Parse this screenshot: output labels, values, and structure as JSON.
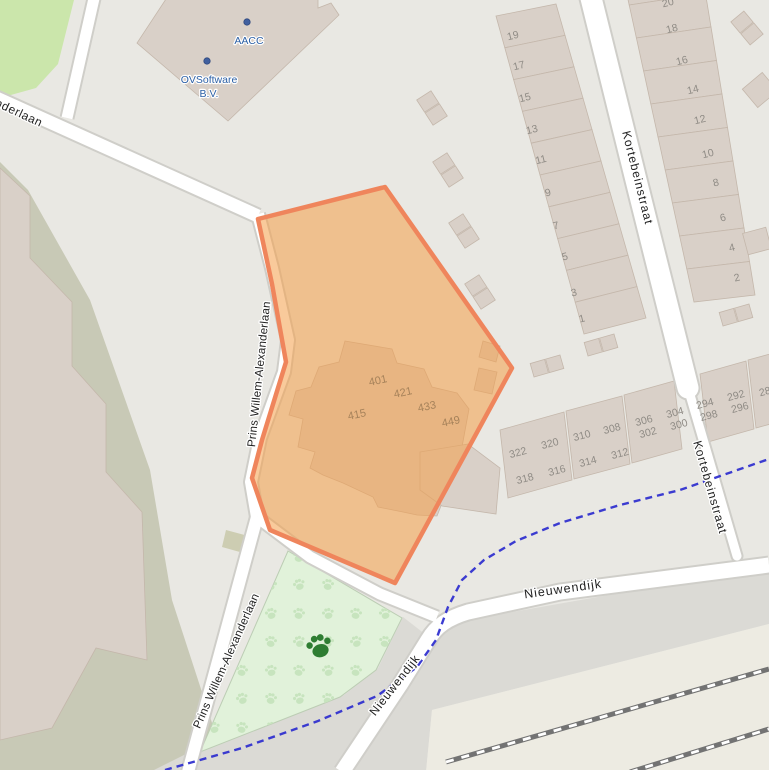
{
  "palette": {
    "bg": "#e9e8e3",
    "building": "#d9d0c8",
    "building_stroke": "#c4b7ab",
    "olive_parcel": "#c8c9b6",
    "grass": "#cbe6ab",
    "park_green": "#e1f2da",
    "park_paw": "#c7e4be",
    "park_paw_dark": "#2e7d32",
    "road_fill": "#ffffff",
    "road_casing": "#cfcec9",
    "gray_band": "#dbdad5",
    "rail_zone": "#edebe2",
    "rail_line": "#737373",
    "cycleway_blue": "#3232cf",
    "street_text": "#222222",
    "house_num_text": "#8f8b85",
    "plot_num_text": "#a6825a",
    "poi_text": "#2b5fa5",
    "poi_dot": "#41609f"
  },
  "selection": {
    "fill": "rgba(244,158,72,0.55)",
    "border": "#ef855c"
  },
  "streets": [
    {
      "label": "nderlaan",
      "x": -4,
      "y": 102,
      "r": 25,
      "fs": 12,
      "ls": 0.5,
      "anchor": "start"
    },
    {
      "label": "Prins Willem-Alexanderlaan",
      "x": 252,
      "y": 447,
      "r": -84,
      "fs": 11.5,
      "ls": 0.2,
      "anchor": "start"
    },
    {
      "label": "Prins Willem-Alexanderlaan",
      "x": 197,
      "y": 728,
      "r": -66,
      "fs": 11.5,
      "ls": 0.2,
      "anchor": "start"
    },
    {
      "label": "Kortebeinstraat",
      "x": 626,
      "y": 131,
      "r": 76,
      "fs": 12,
      "ls": 1,
      "anchor": "start"
    },
    {
      "label": "Kortebeinstraat",
      "x": 697,
      "y": 441,
      "r": 74,
      "fs": 12,
      "ls": 1,
      "anchor": "start"
    },
    {
      "label": "Nieuwendijk",
      "x": 563,
      "y": 589,
      "r": -8,
      "fs": 12.5,
      "ls": 1,
      "anchor": "middle"
    },
    {
      "label": "Nieuwendijk",
      "x": 372,
      "y": 714,
      "r": -52,
      "fs": 12,
      "ls": 0.8,
      "anchor": "start"
    }
  ],
  "pois": [
    {
      "label": "AACC",
      "dx": 247,
      "dy": 22,
      "tx": 249,
      "ty": 44
    },
    {
      "label": "OVSoftware",
      "label2": "B.V.",
      "dx": 207,
      "dy": 61,
      "tx": 209,
      "ty": 83,
      "ty2": 97
    }
  ],
  "house_numbers": [
    {
      "n": "19",
      "x": 513,
      "y": 36,
      "r": -14
    },
    {
      "n": "17",
      "x": 519,
      "y": 66,
      "r": -14
    },
    {
      "n": "15",
      "x": 525,
      "y": 98,
      "r": -14
    },
    {
      "n": "13",
      "x": 532,
      "y": 130,
      "r": -14
    },
    {
      "n": "11",
      "x": 541,
      "y": 160,
      "r": -14
    },
    {
      "n": "9",
      "x": 548,
      "y": 193,
      "r": -14
    },
    {
      "n": "7",
      "x": 556,
      "y": 226,
      "r": -14
    },
    {
      "n": "5",
      "x": 565,
      "y": 257,
      "r": -14
    },
    {
      "n": "3",
      "x": 574,
      "y": 293,
      "r": -14
    },
    {
      "n": "1",
      "x": 582,
      "y": 319,
      "r": -14
    },
    {
      "n": "20",
      "x": 668,
      "y": 3,
      "r": -14
    },
    {
      "n": "18",
      "x": 672,
      "y": 29,
      "r": -14
    },
    {
      "n": "16",
      "x": 682,
      "y": 61,
      "r": -14
    },
    {
      "n": "14",
      "x": 693,
      "y": 90,
      "r": -14
    },
    {
      "n": "12",
      "x": 700,
      "y": 120,
      "r": -14
    },
    {
      "n": "10",
      "x": 708,
      "y": 154,
      "r": -14
    },
    {
      "n": "8",
      "x": 716,
      "y": 183,
      "r": -14
    },
    {
      "n": "6",
      "x": 723,
      "y": 218,
      "r": -14
    },
    {
      "n": "4",
      "x": 732,
      "y": 248,
      "r": -14
    },
    {
      "n": "2",
      "x": 737,
      "y": 278,
      "r": -14
    },
    {
      "n": "322",
      "x": 518,
      "y": 453,
      "r": -15
    },
    {
      "n": "320",
      "x": 550,
      "y": 444,
      "r": -15
    },
    {
      "n": "310",
      "x": 582,
      "y": 436,
      "r": -15
    },
    {
      "n": "308",
      "x": 612,
      "y": 429,
      "r": -15
    },
    {
      "n": "306",
      "x": 644,
      "y": 421,
      "r": -15
    },
    {
      "n": "302",
      "x": 648,
      "y": 433,
      "r": -15
    },
    {
      "n": "304",
      "x": 675,
      "y": 413,
      "r": -15
    },
    {
      "n": "300",
      "x": 679,
      "y": 425,
      "r": -15
    },
    {
      "n": "294",
      "x": 705,
      "y": 404,
      "r": -15
    },
    {
      "n": "298",
      "x": 709,
      "y": 416,
      "r": -15
    },
    {
      "n": "292",
      "x": 736,
      "y": 396,
      "r": -15
    },
    {
      "n": "296",
      "x": 740,
      "y": 408,
      "r": -15
    },
    {
      "n": "28",
      "x": 765,
      "y": 392,
      "r": -15
    },
    {
      "n": "318",
      "x": 525,
      "y": 479,
      "r": -15
    },
    {
      "n": "316",
      "x": 557,
      "y": 471,
      "r": -15
    },
    {
      "n": "314",
      "x": 588,
      "y": 462,
      "r": -15
    },
    {
      "n": "312",
      "x": 620,
      "y": 454,
      "r": -15
    }
  ],
  "plot_numbers": [
    {
      "n": "401",
      "x": 378,
      "y": 381,
      "r": -12
    },
    {
      "n": "421",
      "x": 403,
      "y": 393,
      "r": -12
    },
    {
      "n": "433",
      "x": 427,
      "y": 407,
      "r": -12
    },
    {
      "n": "449",
      "x": 451,
      "y": 422,
      "r": -12
    },
    {
      "n": "415",
      "x": 357,
      "y": 415,
      "r": -12
    }
  ]
}
